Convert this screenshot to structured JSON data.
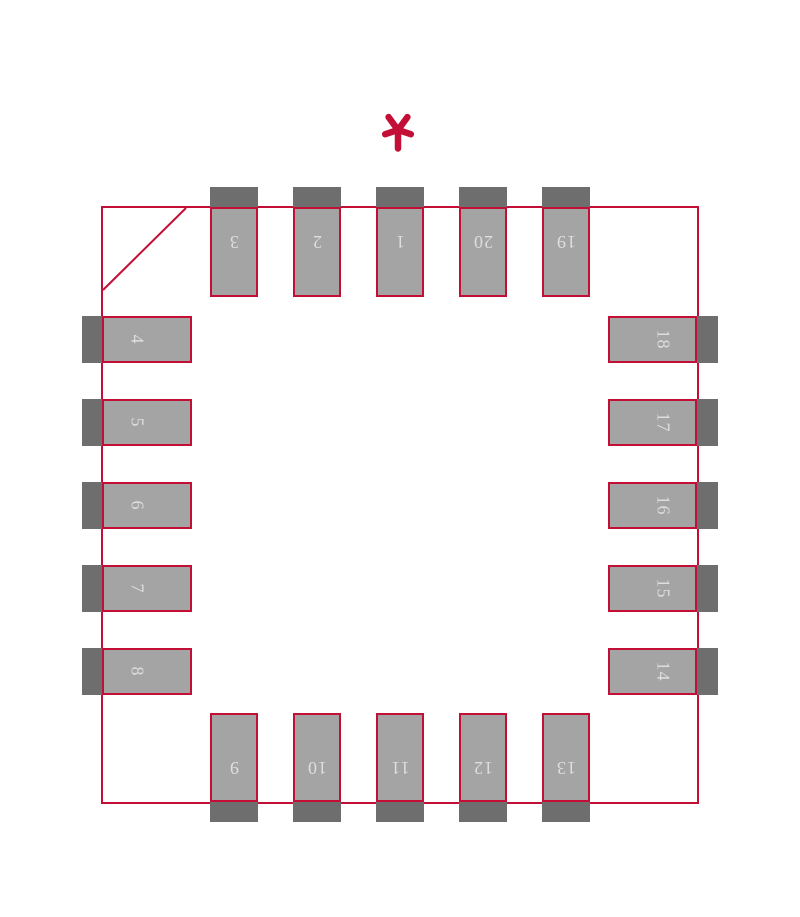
{
  "diagram": {
    "kind": "component-footprint-land-pattern",
    "pin_count": "20",
    "pin1_marker_symbol": "*"
  },
  "colors": {
    "outline": "#C30E36",
    "pad_fill": "#A4A4A4",
    "mask_extension": "#6E6E6E",
    "pad_number_text": "#DEDEDE",
    "background": "#FFFFFF"
  },
  "pads": {
    "top": [
      "3",
      "2",
      "1",
      "20",
      "19"
    ],
    "left": [
      "4",
      "5",
      "6",
      "7",
      "8"
    ],
    "bottom": [
      "9",
      "10",
      "11",
      "12",
      "13"
    ],
    "right": [
      "18",
      "17",
      "16",
      "15",
      "14"
    ]
  }
}
